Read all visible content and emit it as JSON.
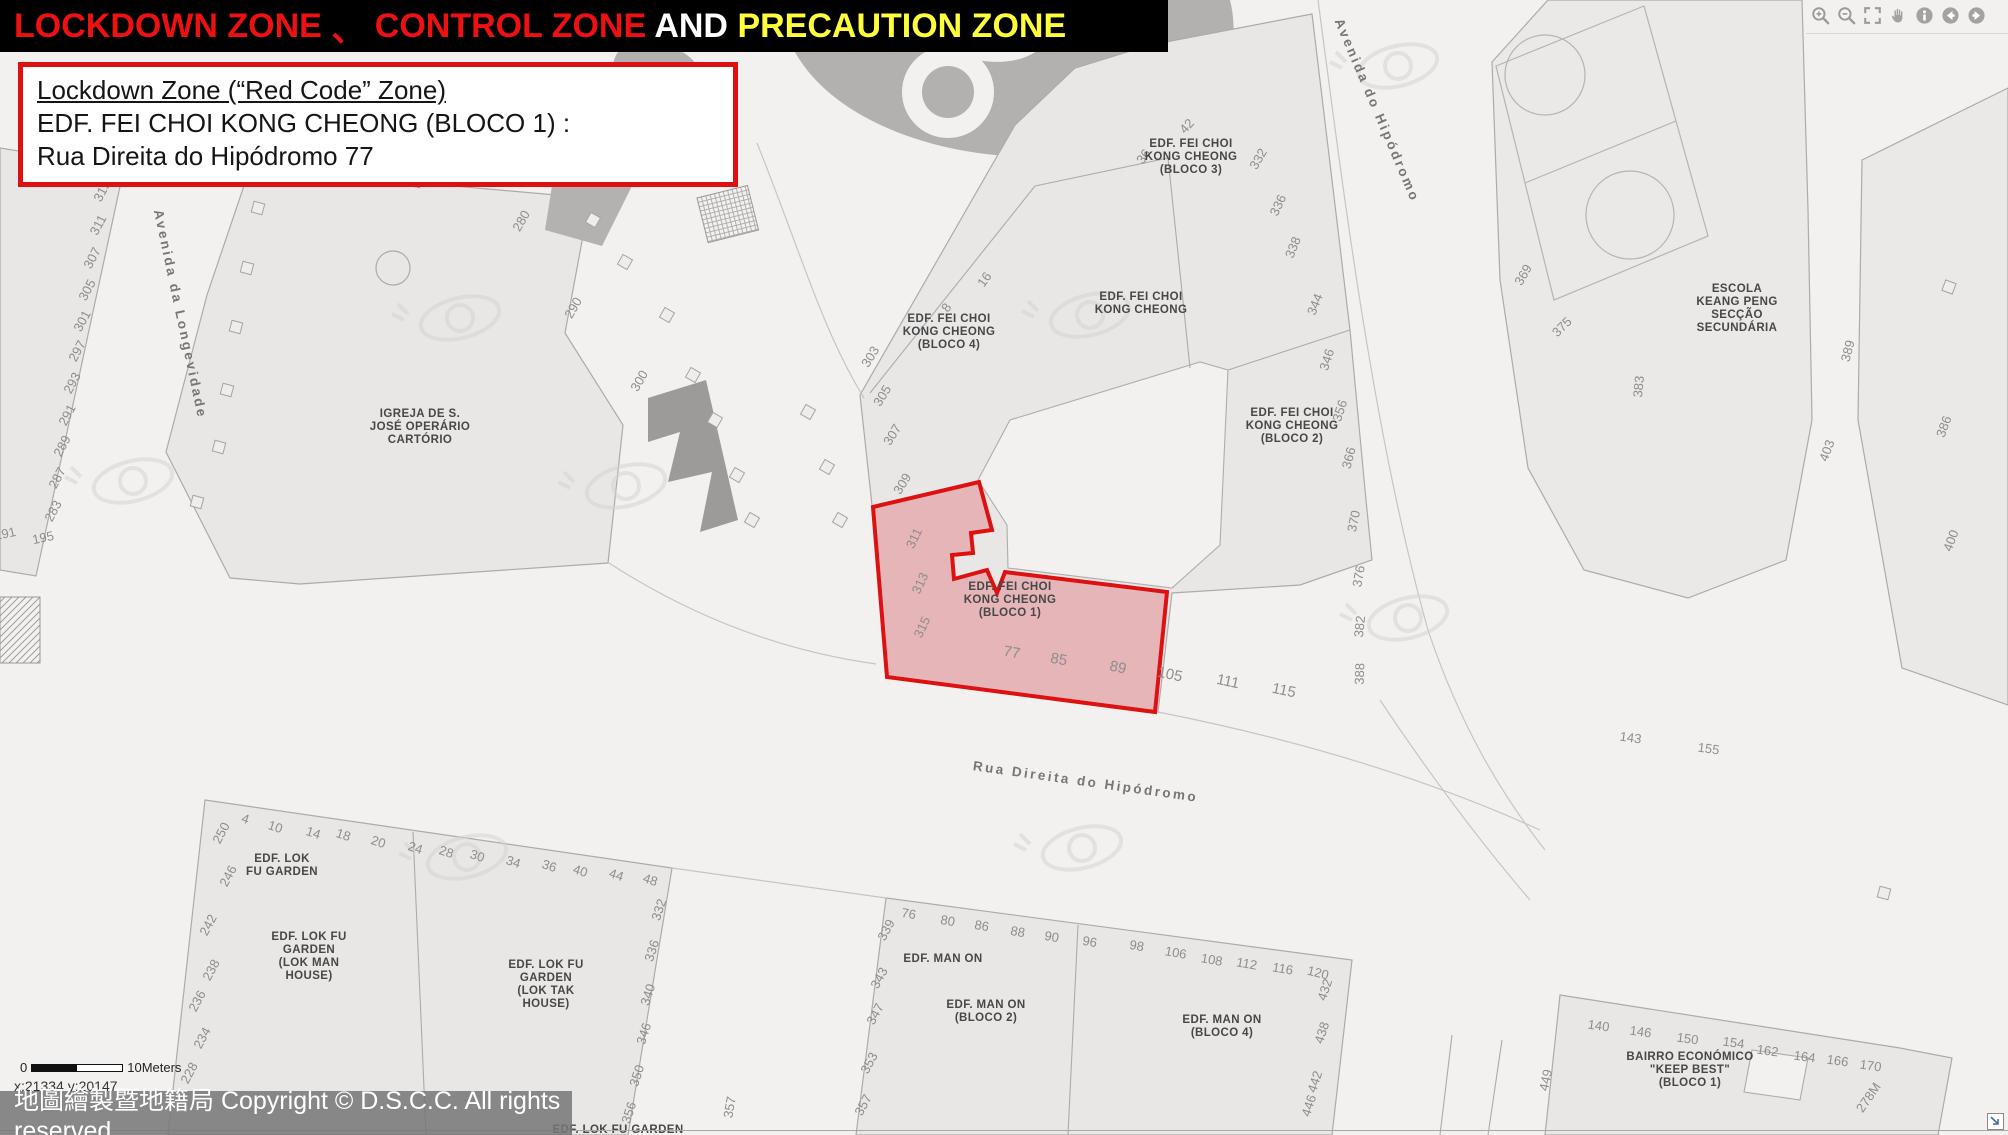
{
  "title_bar": {
    "segments": [
      {
        "text": "LOCKDOWN ZONE ",
        "color": "#ed1111"
      },
      {
        "text": "、 ",
        "color": "#ed1111"
      },
      {
        "text": "CONTROL ZONE",
        "color": "#ed1111"
      },
      {
        "text": " AND ",
        "color": "#ffffff"
      },
      {
        "text": "PRECAUTION ZONE",
        "color": "#fdfd3c"
      }
    ]
  },
  "info_box": {
    "line1": "Lockdown Zone (“Red Code” Zone)",
    "line2": "EDF. FEI CHOI KONG CHEONG (BLOCO 1) :",
    "line3": "Rua Direita do Hipódromo  77",
    "border_color": "#dd1111"
  },
  "toolbar": {
    "icons": [
      {
        "name": "zoom-in-icon"
      },
      {
        "name": "zoom-out-icon"
      },
      {
        "name": "full-extent-icon"
      },
      {
        "name": "pan-icon"
      },
      {
        "name": "identify-icon"
      },
      {
        "name": "previous-view-icon"
      },
      {
        "name": "next-view-icon"
      }
    ]
  },
  "scale_bar": {
    "zero": "0",
    "label": "10Meters"
  },
  "coords": "x:21334 y:20147",
  "copyright": "地圖繪製暨地籍局 Copyright © D.S.C.C. All rights reserved",
  "map": {
    "lockdown_zone": {
      "points": "873,507 979,482 992,530 971,533 973,553 952,555 954,579 987,570 997,593 1005,572 1167,592 1155,712 887,677",
      "fill_color": "#e05a60",
      "fill_opacity": "0.35",
      "stroke_color": "#dd1111"
    },
    "street_labels": [
      {
        "text": "Avenida da Longevidade",
        "x": 176,
        "y": 315,
        "rot": 78
      },
      {
        "text": "Avenida do Hipódromo",
        "x": 1373,
        "y": 112,
        "rot": 67
      },
      {
        "text": "Rua Direita do Hipódromo",
        "x": 1085,
        "y": 786,
        "rot": 8
      }
    ],
    "building_labels": [
      {
        "lines": [
          "EDF. FEI CHOI",
          "KONG CHEONG",
          "(BLOCO 3)"
        ],
        "x": 1191,
        "y": 147
      },
      {
        "lines": [
          "EDF. FEI CHOI",
          "KONG CHEONG"
        ],
        "x": 1141,
        "y": 300
      },
      {
        "lines": [
          "EDF. FEI CHOI",
          "KONG CHEONG",
          "(BLOCO 4)"
        ],
        "x": 949,
        "y": 322
      },
      {
        "lines": [
          "EDF. FEI CHOI",
          "KONG CHEONG",
          "(BLOCO 2)"
        ],
        "x": 1292,
        "y": 416
      },
      {
        "lines": [
          "EDF. FEI CHOI",
          "KONG CHEONG",
          "(BLOCO 1)"
        ],
        "x": 1010,
        "y": 590
      },
      {
        "lines": [
          "IGREJA DE S.",
          "JOSÉ OPERÁRIO",
          "CARTÓRIO"
        ],
        "x": 420,
        "y": 417
      },
      {
        "lines": [
          "ESCOLA",
          "KEANG PENG",
          "SECÇÃO",
          "SECUNDÁRIA"
        ],
        "x": 1737,
        "y": 292
      },
      {
        "lines": [
          "EDF. LOK",
          "FU GARDEN"
        ],
        "x": 282,
        "y": 862
      },
      {
        "lines": [
          "EDF. LOK FU",
          "GARDEN",
          "(LOK MAN",
          "HOUSE)"
        ],
        "x": 309,
        "y": 940
      },
      {
        "lines": [
          "EDF. LOK FU",
          "GARDEN",
          "(LOK TAK",
          "HOUSE)"
        ],
        "x": 546,
        "y": 968
      },
      {
        "lines": [
          "EDF. MAN ON"
        ],
        "x": 943,
        "y": 962
      },
      {
        "lines": [
          "EDF. MAN ON",
          "(BLOCO 2)"
        ],
        "x": 986,
        "y": 1008
      },
      {
        "lines": [
          "EDF. MAN ON",
          "(BLOCO 4)"
        ],
        "x": 1222,
        "y": 1023
      },
      {
        "lines": [
          "BAIRRO ECONÓMICO",
          "\"KEEP BEST\"",
          "(BLOCO 1)"
        ],
        "x": 1690,
        "y": 1060
      },
      {
        "lines": [
          "EDF. LOK FU GARDEN"
        ],
        "x": 618,
        "y": 1133
      }
    ],
    "numbers": [
      {
        "t": "315",
        "x": 106,
        "y": 193,
        "r": -62
      },
      {
        "t": "311",
        "x": 102,
        "y": 227,
        "r": -62
      },
      {
        "t": "307",
        "x": 96,
        "y": 260,
        "r": -62
      },
      {
        "t": "305",
        "x": 91,
        "y": 292,
        "r": -62
      },
      {
        "t": "301",
        "x": 86,
        "y": 323,
        "r": -62
      },
      {
        "t": "297",
        "x": 81,
        "y": 353,
        "r": -62
      },
      {
        "t": "293",
        "x": 76,
        "y": 385,
        "r": -62
      },
      {
        "t": "291",
        "x": 71,
        "y": 417,
        "r": -62
      },
      {
        "t": "289",
        "x": 66,
        "y": 448,
        "r": -62
      },
      {
        "t": "287",
        "x": 61,
        "y": 480,
        "r": -62
      },
      {
        "t": "283",
        "x": 57,
        "y": 513,
        "r": -62
      },
      {
        "t": "191",
        "x": 6,
        "y": 538,
        "r": -12
      },
      {
        "t": "195",
        "x": 44,
        "y": 542,
        "r": -12
      },
      {
        "t": "280",
        "x": 525,
        "y": 223,
        "r": -60
      },
      {
        "t": "290",
        "x": 577,
        "y": 310,
        "r": -60
      },
      {
        "t": "300",
        "x": 643,
        "y": 383,
        "r": -60
      },
      {
        "t": "303",
        "x": 874,
        "y": 359,
        "r": -58
      },
      {
        "t": "305",
        "x": 886,
        "y": 398,
        "r": -58
      },
      {
        "t": "307",
        "x": 896,
        "y": 437,
        "r": -58
      },
      {
        "t": "309",
        "x": 906,
        "y": 486,
        "r": -58
      },
      {
        "t": "311",
        "x": 918,
        "y": 540,
        "r": -65
      },
      {
        "t": "313",
        "x": 924,
        "y": 585,
        "r": -65
      },
      {
        "t": "315",
        "x": 926,
        "y": 629,
        "r": -65
      },
      {
        "t": "8",
        "x": 950,
        "y": 310,
        "r": -55
      },
      {
        "t": "16",
        "x": 988,
        "y": 282,
        "r": -55
      },
      {
        "t": "36",
        "x": 1147,
        "y": 159,
        "r": -55
      },
      {
        "t": "42",
        "x": 1190,
        "y": 129,
        "r": -48
      },
      {
        "t": "332",
        "x": 1262,
        "y": 161,
        "r": -60
      },
      {
        "t": "336",
        "x": 1282,
        "y": 207,
        "r": -65
      },
      {
        "t": "338",
        "x": 1297,
        "y": 249,
        "r": -68
      },
      {
        "t": "344",
        "x": 1319,
        "y": 306,
        "r": -68
      },
      {
        "t": "346",
        "x": 1331,
        "y": 361,
        "r": -72
      },
      {
        "t": "356",
        "x": 1344,
        "y": 412,
        "r": -72
      },
      {
        "t": "366",
        "x": 1353,
        "y": 459,
        "r": -75
      },
      {
        "t": "370",
        "x": 1358,
        "y": 522,
        "r": -78
      },
      {
        "t": "376",
        "x": 1363,
        "y": 577,
        "r": -80
      },
      {
        "t": "382",
        "x": 1364,
        "y": 627,
        "r": -84
      },
      {
        "t": "388",
        "x": 1364,
        "y": 674,
        "r": -88
      },
      {
        "t": "77",
        "x": 1011,
        "y": 657,
        "r": 10,
        "s": 15
      },
      {
        "t": "85",
        "x": 1058,
        "y": 664,
        "r": 10,
        "s": 15
      },
      {
        "t": "89",
        "x": 1117,
        "y": 672,
        "r": 12,
        "s": 15
      },
      {
        "t": "105",
        "x": 1169,
        "y": 679,
        "r": 12,
        "s": 15
      },
      {
        "t": "111",
        "x": 1227,
        "y": 686,
        "r": 12,
        "s": 15
      },
      {
        "t": "115",
        "x": 1283,
        "y": 695,
        "r": 12,
        "s": 15
      },
      {
        "t": "369",
        "x": 1527,
        "y": 277,
        "r": -60
      },
      {
        "t": "375",
        "x": 1565,
        "y": 330,
        "r": -45
      },
      {
        "t": "383",
        "x": 1643,
        "y": 387,
        "r": -85
      },
      {
        "t": "389",
        "x": 1852,
        "y": 352,
        "r": -75
      },
      {
        "t": "403",
        "x": 1831,
        "y": 452,
        "r": -70
      },
      {
        "t": "386",
        "x": 1948,
        "y": 428,
        "r": -70
      },
      {
        "t": "400",
        "x": 1955,
        "y": 542,
        "r": -70
      },
      {
        "t": "143",
        "x": 1630,
        "y": 742,
        "r": 8
      },
      {
        "t": "155",
        "x": 1708,
        "y": 753,
        "r": 8
      },
      {
        "t": "250",
        "x": 225,
        "y": 835,
        "r": -62
      },
      {
        "t": "4",
        "x": 244,
        "y": 823,
        "r": 18
      },
      {
        "t": "10",
        "x": 274,
        "y": 831,
        "r": 18
      },
      {
        "t": "14",
        "x": 312,
        "y": 837,
        "r": 18
      },
      {
        "t": "18",
        "x": 342,
        "y": 839,
        "r": 18
      },
      {
        "t": "20",
        "x": 377,
        "y": 846,
        "r": 18
      },
      {
        "t": "24",
        "x": 414,
        "y": 852,
        "r": 18
      },
      {
        "t": "28",
        "x": 445,
        "y": 856,
        "r": 18
      },
      {
        "t": "30",
        "x": 476,
        "y": 860,
        "r": 18
      },
      {
        "t": "34",
        "x": 512,
        "y": 866,
        "r": 18
      },
      {
        "t": "36",
        "x": 548,
        "y": 870,
        "r": 18
      },
      {
        "t": "40",
        "x": 579,
        "y": 875,
        "r": 18
      },
      {
        "t": "44",
        "x": 615,
        "y": 879,
        "r": 18
      },
      {
        "t": "48",
        "x": 649,
        "y": 884,
        "r": 18
      },
      {
        "t": "246",
        "x": 232,
        "y": 878,
        "r": -62
      },
      {
        "t": "242",
        "x": 212,
        "y": 927,
        "r": -62
      },
      {
        "t": "238",
        "x": 215,
        "y": 972,
        "r": -62
      },
      {
        "t": "236",
        "x": 201,
        "y": 1003,
        "r": -62
      },
      {
        "t": "234",
        "x": 206,
        "y": 1040,
        "r": -62
      },
      {
        "t": "228",
        "x": 193,
        "y": 1075,
        "r": -62
      },
      {
        "t": "332",
        "x": 663,
        "y": 911,
        "r": -72
      },
      {
        "t": "336",
        "x": 656,
        "y": 952,
        "r": -72
      },
      {
        "t": "340",
        "x": 652,
        "y": 996,
        "r": -72
      },
      {
        "t": "346",
        "x": 648,
        "y": 1035,
        "r": -72
      },
      {
        "t": "350",
        "x": 641,
        "y": 1077,
        "r": -72
      },
      {
        "t": "356",
        "x": 633,
        "y": 1114,
        "r": -72
      },
      {
        "t": "357",
        "x": 734,
        "y": 1108,
        "r": -80
      },
      {
        "t": "76",
        "x": 908,
        "y": 918,
        "r": 10
      },
      {
        "t": "80",
        "x": 947,
        "y": 925,
        "r": 10
      },
      {
        "t": "86",
        "x": 981,
        "y": 930,
        "r": 10
      },
      {
        "t": "88",
        "x": 1017,
        "y": 936,
        "r": 10
      },
      {
        "t": "90",
        "x": 1051,
        "y": 941,
        "r": 10
      },
      {
        "t": "96",
        "x": 1089,
        "y": 946,
        "r": 10
      },
      {
        "t": "98",
        "x": 1136,
        "y": 950,
        "r": 10
      },
      {
        "t": "106",
        "x": 1175,
        "y": 957,
        "r": 10
      },
      {
        "t": "108",
        "x": 1211,
        "y": 964,
        "r": 10
      },
      {
        "t": "112",
        "x": 1246,
        "y": 968,
        "r": 10
      },
      {
        "t": "116",
        "x": 1282,
        "y": 973,
        "r": 10
      },
      {
        "t": "120",
        "x": 1317,
        "y": 977,
        "r": 14
      },
      {
        "t": "339",
        "x": 890,
        "y": 932,
        "r": -62
      },
      {
        "t": "343",
        "x": 883,
        "y": 980,
        "r": -62
      },
      {
        "t": "347",
        "x": 879,
        "y": 1016,
        "r": -62
      },
      {
        "t": "353",
        "x": 873,
        "y": 1065,
        "r": -62
      },
      {
        "t": "357",
        "x": 867,
        "y": 1107,
        "r": -62
      },
      {
        "t": "432",
        "x": 1329,
        "y": 991,
        "r": -72
      },
      {
        "t": "438",
        "x": 1326,
        "y": 1034,
        "r": -72
      },
      {
        "t": "442",
        "x": 1319,
        "y": 1083,
        "r": -72
      },
      {
        "t": "446",
        "x": 1313,
        "y": 1107,
        "r": -72
      },
      {
        "t": "140",
        "x": 1598,
        "y": 1030,
        "r": 8
      },
      {
        "t": "146",
        "x": 1640,
        "y": 1036,
        "r": 8
      },
      {
        "t": "150",
        "x": 1687,
        "y": 1043,
        "r": 8
      },
      {
        "t": "154",
        "x": 1733,
        "y": 1047,
        "r": 8
      },
      {
        "t": "162",
        "x": 1767,
        "y": 1055,
        "r": 8
      },
      {
        "t": "164",
        "x": 1804,
        "y": 1061,
        "r": 8
      },
      {
        "t": "166",
        "x": 1837,
        "y": 1065,
        "r": 8
      },
      {
        "t": "170",
        "x": 1870,
        "y": 1070,
        "r": 8
      },
      {
        "t": "449",
        "x": 1550,
        "y": 1081,
        "r": -78
      },
      {
        "t": "278M",
        "x": 1872,
        "y": 1100,
        "r": -55
      }
    ],
    "planter_squares": [
      {
        "x": 258,
        "y": 208,
        "r": 15
      },
      {
        "x": 247,
        "y": 268,
        "r": 15
      },
      {
        "x": 236,
        "y": 327,
        "r": 15
      },
      {
        "x": 227,
        "y": 390,
        "r": 15
      },
      {
        "x": 219,
        "y": 447,
        "r": 15
      },
      {
        "x": 197,
        "y": 502,
        "r": 15
      },
      {
        "x": 593,
        "y": 220,
        "r": 30
      },
      {
        "x": 625,
        "y": 262,
        "r": 30
      },
      {
        "x": 667,
        "y": 315,
        "r": 30
      },
      {
        "x": 693,
        "y": 375,
        "r": 30
      },
      {
        "x": 715,
        "y": 420,
        "r": 30
      },
      {
        "x": 737,
        "y": 475,
        "r": 30
      },
      {
        "x": 752,
        "y": 520,
        "r": 30
      },
      {
        "x": 808,
        "y": 412,
        "r": 30
      },
      {
        "x": 827,
        "y": 467,
        "r": 30
      },
      {
        "x": 840,
        "y": 520,
        "r": 30
      },
      {
        "x": 1949,
        "y": 287,
        "r": 20
      },
      {
        "x": 1884,
        "y": 893,
        "r": 15
      }
    ],
    "watermarks": [
      {
        "x": 460,
        "y": 318
      },
      {
        "x": 1090,
        "y": 315
      },
      {
        "x": 1398,
        "y": 66
      },
      {
        "x": 1408,
        "y": 618
      },
      {
        "x": 1082,
        "y": 848
      },
      {
        "x": 467,
        "y": 857
      },
      {
        "x": 133,
        "y": 481
      },
      {
        "x": 626,
        "y": 486
      }
    ]
  },
  "corner_icon": {
    "name": "overview-map-toggle-icon"
  }
}
